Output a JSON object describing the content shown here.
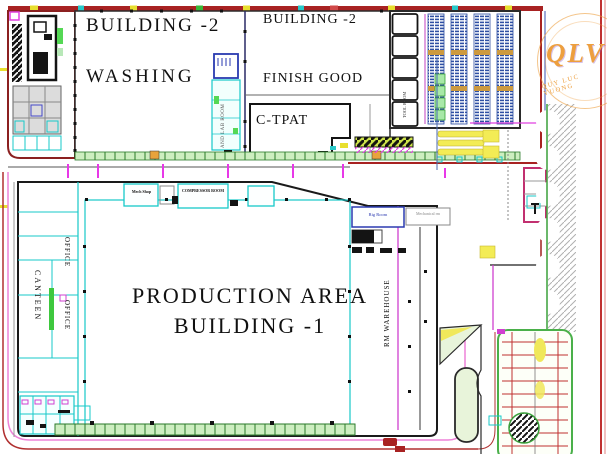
{
  "plan": {
    "building2": {
      "title_left": "BUILDING -2",
      "title_right": "BUILDING -2",
      "washing": "WASHING",
      "finish_good": "FINISH GOOD",
      "ctpat": "C-TPAT",
      "lab_room": "AND LAB ROOM",
      "tool_room": "TOOL ROOM"
    },
    "building1": {
      "title_line1": "PRODUCTION AREA",
      "title_line2": "BUILDING -1",
      "canteen": "CANTEEN",
      "office_upper": "OFFICE",
      "office_lower": "OFFICE",
      "rm_warehouse": "RM WAREHOUSE",
      "mech_shop": "Mech Shop",
      "compressor_room": "COMPRESSOR ROOM",
      "rig_room": "Rig Room",
      "mechanical_room": "Mechanical rm"
    },
    "logo": {
      "text": "QLV",
      "subtext": "QUY LUC VUONG"
    },
    "colors": {
      "boundary_red": "#a82222",
      "road_pink": "#ee82d8",
      "wall_cyan": "#17c9c9",
      "rack_blue": "#2e4fa3",
      "walkway_green": "#cdeec0",
      "accent_yellow": "#f3ec55",
      "logo_orange": "#ed9f3e"
    }
  }
}
